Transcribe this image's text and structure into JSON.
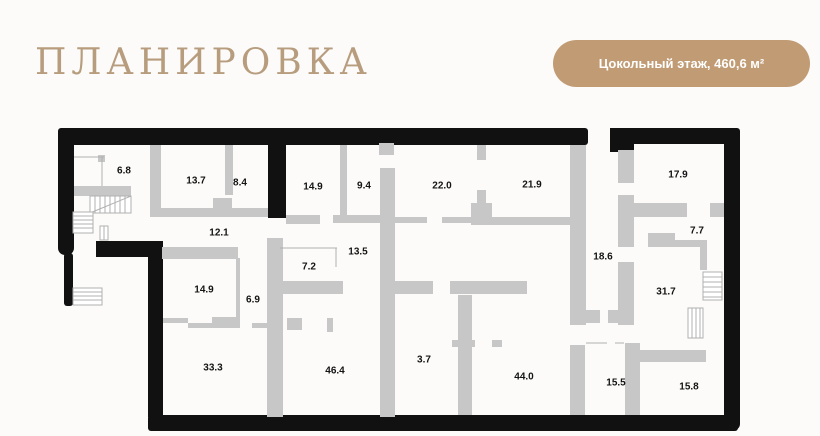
{
  "header": {
    "title": "ПЛАНИРОВКА"
  },
  "badge": {
    "label": "Цокольный этаж, 460,6 м²"
  },
  "plan": {
    "rooms": [
      {
        "area": "6.8",
        "x": 124,
        "y": 171
      },
      {
        "area": "13.7",
        "x": 196,
        "y": 181
      },
      {
        "area": "8.4",
        "x": 240,
        "y": 183
      },
      {
        "area": "14.9",
        "x": 313,
        "y": 187
      },
      {
        "area": "9.4",
        "x": 364,
        "y": 186
      },
      {
        "area": "22.0",
        "x": 442,
        "y": 186
      },
      {
        "area": "21.9",
        "x": 532,
        "y": 185
      },
      {
        "area": "17.9",
        "x": 678,
        "y": 175
      },
      {
        "area": "12.1",
        "x": 219,
        "y": 233
      },
      {
        "area": "13.5",
        "x": 358,
        "y": 252
      },
      {
        "area": "7.2",
        "x": 309,
        "y": 267
      },
      {
        "area": "18.6",
        "x": 603,
        "y": 257
      },
      {
        "area": "7.7",
        "x": 697,
        "y": 231
      },
      {
        "area": "14.9",
        "x": 204,
        "y": 290
      },
      {
        "area": "6.9",
        "x": 253,
        "y": 300
      },
      {
        "area": "31.7",
        "x": 666,
        "y": 292
      },
      {
        "area": "33.3",
        "x": 213,
        "y": 368
      },
      {
        "area": "46.4",
        "x": 335,
        "y": 371
      },
      {
        "area": "3.7",
        "x": 424,
        "y": 360
      },
      {
        "area": "44.0",
        "x": 524,
        "y": 377
      },
      {
        "area": "15.5",
        "x": 616,
        "y": 383
      },
      {
        "area": "15.8",
        "x": 689,
        "y": 387
      }
    ]
  },
  "colors": {
    "accent": "#b79d7e",
    "badge_bg": "#c09b74",
    "wall_black": "#111111",
    "wall_gray": "#c7c7c7",
    "thin_line": "#b0b0b0",
    "page_bg": "#fcfbf9"
  }
}
